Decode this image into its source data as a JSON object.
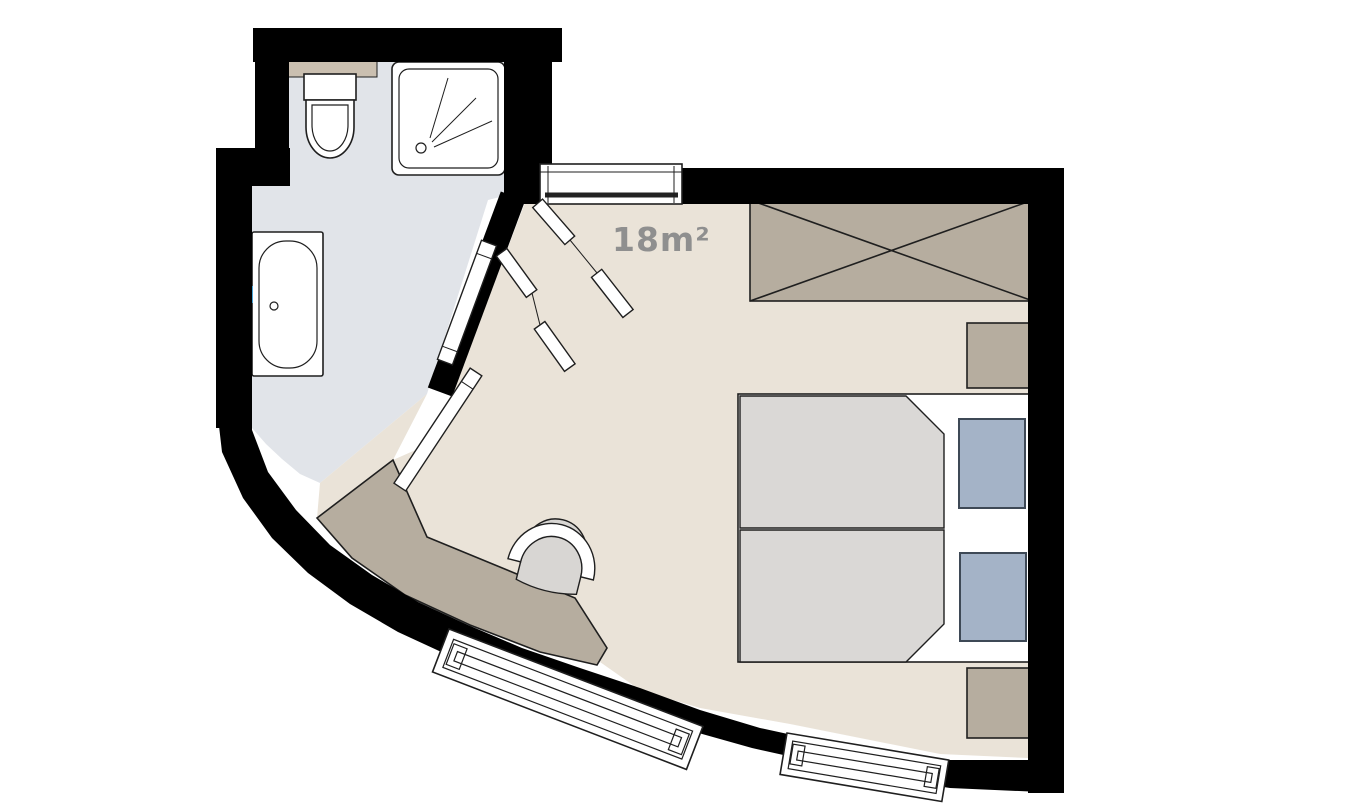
{
  "room": {
    "area_label": "18m²"
  },
  "colors": {
    "wall": "#000000",
    "outline": "#1f1f1f",
    "bathFloor": "#e1e4e9",
    "bedFloor": "#eae3d8",
    "furniture": "#b6ad9f",
    "counter": "#cabfb0",
    "duvet": "#dad8d6",
    "pillow": "#a4b3c7",
    "pillowStroke": "#3e4956",
    "chairSeat": "#d8d6d3",
    "fixtureWhite": "#ffffff",
    "label": "#8f8f8f",
    "faucet": "#49a5d6"
  }
}
